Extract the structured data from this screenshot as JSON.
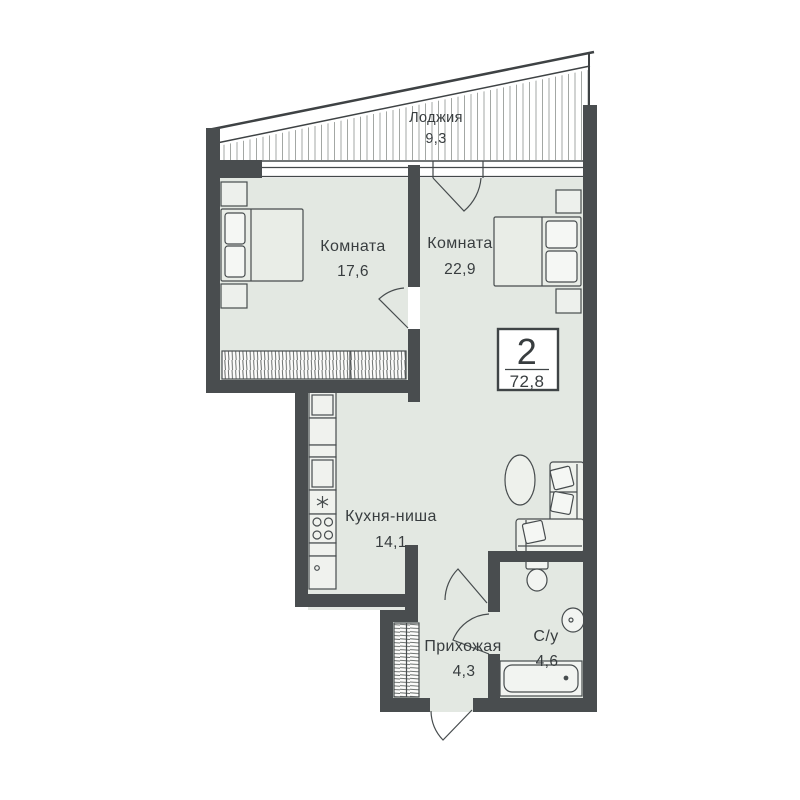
{
  "plan": {
    "title": "Floor plan of 2-room apartment",
    "stamp": {
      "rooms_count": "2",
      "total_area": "72,8"
    },
    "rooms": [
      {
        "id": "loggia",
        "name": "Лоджия",
        "area": "9,3"
      },
      {
        "id": "room-1",
        "name": "Комната",
        "area": "17,6"
      },
      {
        "id": "room-2",
        "name": "Комната",
        "area": "22,9"
      },
      {
        "id": "kitchen",
        "name": "Кухня-ниша",
        "area": "14,1"
      },
      {
        "id": "hallway",
        "name": "Прихожая",
        "area": "4,3"
      },
      {
        "id": "bathroom",
        "name": "С/у",
        "area": "4,6"
      }
    ],
    "colors": {
      "paper": "#ffffff",
      "floor": "#e3e8e2",
      "wall": "#494d4f",
      "outline": "#474c4e",
      "text": "#383d3f",
      "hatch": "#a3a7a4"
    }
  }
}
